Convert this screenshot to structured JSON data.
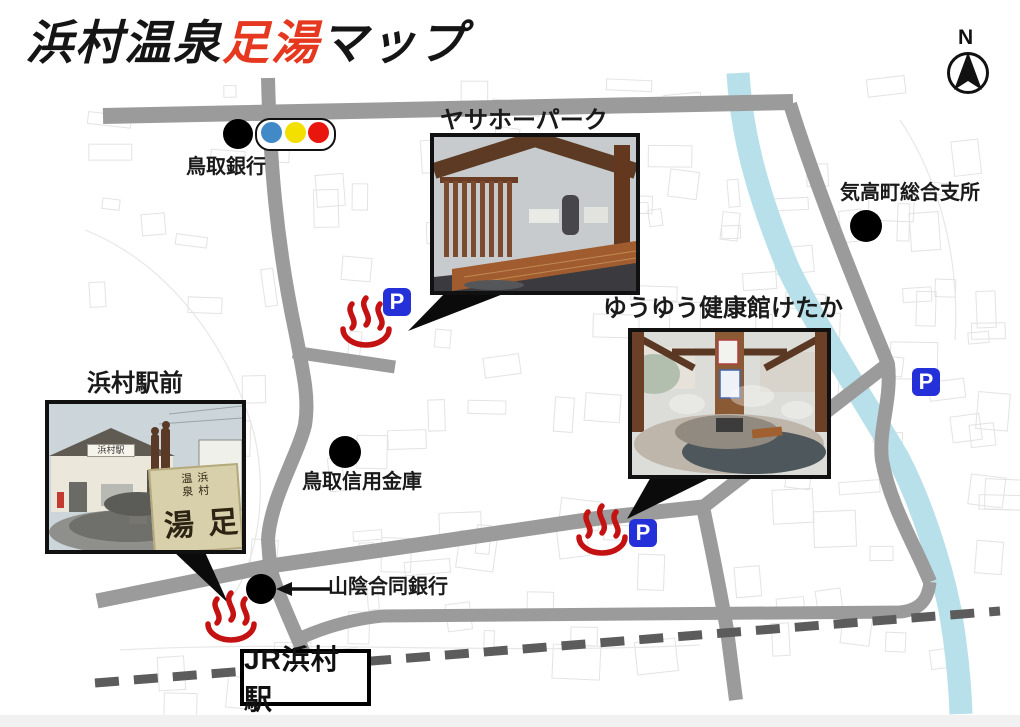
{
  "header": {
    "title_part1": "浜村温泉",
    "title_part2": "足湯",
    "title_part3": "マップ"
  },
  "compass": {
    "north_label": "N"
  },
  "map": {
    "parking_label": "P",
    "landmarks": {
      "tottori_bank": {
        "label": "鳥取銀行"
      },
      "ketaka_office": {
        "label": "気高町総合支所"
      },
      "tottori_shinkin": {
        "label": "鳥取信用金庫"
      },
      "sanin_godo_bank": {
        "label": "山陰合同銀行"
      },
      "jr_hamamura_station": {
        "label": "JR浜村駅"
      }
    },
    "photo_spots": {
      "yasaho_park": {
        "label": "ヤサホーパーク"
      },
      "yuyu_kenkokan_ketaka": {
        "label": "ゆうゆう健康館けたか"
      },
      "hamamura_ekimae": {
        "label": "浜村駅前",
        "photo_sign_station": "浜村駅",
        "photo_sign_small": "浜村温泉",
        "photo_sign_large": "足湯"
      }
    },
    "colors": {
      "road": "#9b9b9b",
      "railway": "#5c5c5c",
      "river": "#b8e0ea",
      "onsen_red": "#c41111",
      "parking_blue": "#2430d8",
      "title_red": "#e5381f",
      "signal_blue": "#4189c7",
      "signal_yellow": "#f3df00",
      "signal_red": "#e8160c"
    }
  }
}
